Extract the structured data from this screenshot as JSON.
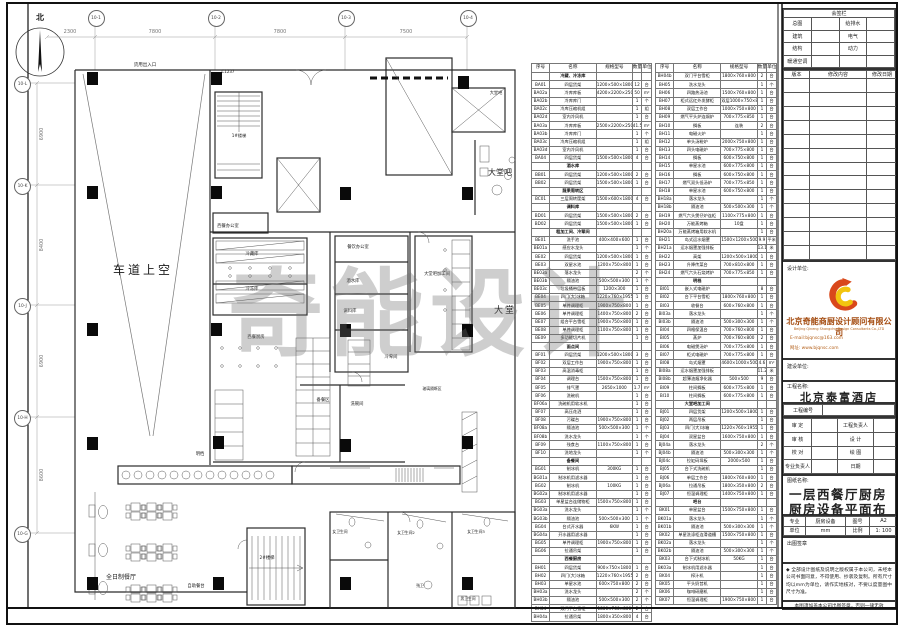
{
  "plan": {
    "north_label": "北",
    "watermark": "奇能设计",
    "grid_top": [
      {
        "id": "10-1",
        "x": 95
      },
      {
        "id": "10-2",
        "x": 215
      },
      {
        "id": "10-3",
        "x": 345
      },
      {
        "id": "10-4",
        "x": 467
      }
    ],
    "dims_top": [
      {
        "v": "2300",
        "x": 70
      },
      {
        "v": "7800",
        "x": 155
      },
      {
        "v": "7800",
        "x": 280
      },
      {
        "v": "7500",
        "x": 406
      }
    ],
    "grid_left": [
      {
        "id": "10-L",
        "y": 83
      },
      {
        "id": "10-K",
        "y": 185
      },
      {
        "id": "10-J",
        "y": 305
      },
      {
        "id": "10-H",
        "y": 417
      },
      {
        "id": "10-G",
        "y": 533
      }
    ],
    "dims_left": [
      {
        "v": "6900",
        "y": 134
      },
      {
        "v": "8400",
        "y": 245
      },
      {
        "v": "6900",
        "y": 361
      },
      {
        "v": "8600",
        "y": 475
      }
    ],
    "columns": [
      [
        92,
        78
      ],
      [
        216,
        78
      ],
      [
        463,
        82
      ],
      [
        92,
        192
      ],
      [
        216,
        192
      ],
      [
        345,
        193
      ],
      [
        467,
        193
      ],
      [
        92,
        329
      ],
      [
        216,
        329
      ],
      [
        345,
        330
      ],
      [
        467,
        330
      ],
      [
        92,
        443
      ],
      [
        218,
        442
      ],
      [
        345,
        445
      ],
      [
        467,
        442
      ],
      [
        92,
        583
      ],
      [
        218,
        583
      ],
      [
        345,
        583
      ],
      [
        467,
        583
      ]
    ],
    "labels": [
      {
        "t": "北",
        "x": 40,
        "y": 12,
        "s": 8,
        "b": 1
      },
      {
        "t": "货用出入口",
        "x": 145,
        "y": 62,
        "s": 4.5
      },
      {
        "t": "C1237",
        "x": 228,
        "y": 69,
        "s": 4
      },
      {
        "t": "1#楼梯",
        "x": 239,
        "y": 133,
        "s": 4.2
      },
      {
        "t": "大堂吧",
        "x": 496,
        "y": 90,
        "s": 4.2
      },
      {
        "t": "大堂吧",
        "x": 500,
        "y": 167,
        "s": 8
      },
      {
        "t": "车道上空",
        "x": 143,
        "y": 261,
        "s": 12,
        "ls": 3
      },
      {
        "t": "西餐办公室",
        "x": 228,
        "y": 223,
        "s": 4.3
      },
      {
        "t": "冷藏库",
        "x": 252,
        "y": 251,
        "s": 4.3
      },
      {
        "t": "冷冻库",
        "x": 252,
        "y": 286,
        "s": 4.3
      },
      {
        "t": "餐饮办公室",
        "x": 358,
        "y": 244,
        "s": 4.3
      },
      {
        "t": "酒水库",
        "x": 353,
        "y": 278,
        "s": 4.3
      },
      {
        "t": "调料库",
        "x": 350,
        "y": 308,
        "s": 4.3
      },
      {
        "t": "冷荤间",
        "x": 391,
        "y": 354,
        "s": 4.3
      },
      {
        "t": "大堂吧加工间",
        "x": 437,
        "y": 271,
        "s": 4.3
      },
      {
        "t": "大堂",
        "x": 505,
        "y": 303,
        "s": 9,
        "ls": 2
      },
      {
        "t": "西餐厨房",
        "x": 256,
        "y": 334,
        "s": 4.3
      },
      {
        "t": "备餐区",
        "x": 323,
        "y": 397,
        "s": 4.3
      },
      {
        "t": "洗碗间",
        "x": 357,
        "y": 401,
        "s": 4.3
      },
      {
        "t": "玻璃隔断区",
        "x": 432,
        "y": 386,
        "s": 3.8
      },
      {
        "t": "明档",
        "x": 200,
        "y": 451,
        "s": 4.3
      },
      {
        "t": "自助餐台",
        "x": 196,
        "y": 583,
        "s": 4.3
      },
      {
        "t": "2#楼梯",
        "x": 267,
        "y": 555,
        "s": 4.3
      },
      {
        "t": "全日制餐厅",
        "x": 121,
        "y": 572,
        "s": 6
      },
      {
        "t": "女卫生间",
        "x": 340,
        "y": 529,
        "s": 3.8
      },
      {
        "t": "女卫生间2",
        "x": 406,
        "y": 530,
        "s": 3.8
      },
      {
        "t": "女卫生间3",
        "x": 476,
        "y": 529,
        "s": 3.8
      },
      {
        "t": "残卫",
        "x": 420,
        "y": 583,
        "s": 3.8
      },
      {
        "t": "男卫生间",
        "x": 468,
        "y": 596,
        "s": 3.8
      }
    ]
  },
  "tables": {
    "headers": [
      "序号",
      "名称",
      "规格型号",
      "数量",
      "单位"
    ],
    "left_rows": [
      {
        "s": "冷藏、冷冻库"
      },
      [
        "BA01",
        "四层货架",
        "1200×500×1800",
        "12",
        "台"
      ],
      [
        "BA02a",
        "冷库库板",
        "4200×2200×2500",
        "50",
        "m²"
      ],
      [
        "BA02b",
        "冷库库门",
        "",
        "1",
        "个"
      ],
      [
        "BA02c",
        "冷库压缩机组",
        "",
        "1",
        "组"
      ],
      [
        "BA02d",
        "室内冷风机",
        "",
        "1",
        "台"
      ],
      [
        "BA03a",
        "冷库库板",
        "2500×2200×2500",
        "41.5",
        "m²"
      ],
      [
        "BA03b",
        "冷库库门",
        "",
        "1",
        "个"
      ],
      [
        "BA03c",
        "冷库压缩机组",
        "",
        "1",
        "组"
      ],
      [
        "BA03d",
        "室内冷风机",
        "",
        "1",
        "台"
      ],
      [
        "BA04",
        "四层货架",
        "1500×500×1800",
        "4",
        "台"
      ],
      {
        "s": "酒水库"
      },
      [
        "BB01",
        "四层货架",
        "1200×500×1800",
        "2",
        "台"
      ],
      [
        "BB02",
        "四层货架",
        "1500×500×1800",
        "1",
        "台"
      ],
      {
        "s": "蔬果周转区"
      },
      [
        "BC01",
        "三层周转筐架",
        "1500×600×1800",
        "4",
        "台"
      ],
      {
        "s": "调料库"
      },
      [
        "BD01",
        "四层货架",
        "1500×500×1800",
        "2",
        "台"
      ],
      [
        "BD02",
        "四层货架",
        "1500×500×1800",
        "1",
        "台"
      ],
      {
        "s": "粗加工间、冷荤间"
      },
      [
        "BE01",
        "洗手池",
        "400×400×600",
        "1",
        "台"
      ],
      [
        "BE01a",
        "感应水龙头",
        "",
        "1",
        "个"
      ],
      [
        "BE02",
        "四层货架",
        "1200×500×1800",
        "1",
        "台"
      ],
      [
        "BE03",
        "双星水池",
        "1200×750×800",
        "1",
        "台"
      ],
      [
        "BE03a",
        "落水龙头",
        "",
        "2",
        "个"
      ],
      [
        "BE03b",
        "隔油池",
        "500×500×300",
        "1",
        "个"
      ],
      [
        "BE03c",
        "垃圾桶带层板",
        "1200×300",
        "1",
        "台"
      ],
      [
        "BE04",
        "四门(大)冰箱",
        "1220×760×1955",
        "1",
        "台"
      ],
      [
        "BE05",
        "单件调理柜",
        "1900×750×800",
        "1",
        "台"
      ],
      [
        "BE06",
        "单件调理柜",
        "1400×750×800",
        "2",
        "台"
      ],
      [
        "BE07",
        "组合平台雪柜",
        "1900×750×800",
        "1",
        "台"
      ],
      [
        "BE08",
        "单件调理柜",
        "1100×750×800",
        "1",
        "台"
      ],
      [
        "BE09",
        "多功能切片机",
        "",
        "1",
        "台"
      ],
      {
        "s": "面点间"
      },
      [
        "BF01",
        "四层货架",
        "1200×500×1800",
        "3",
        "台"
      ],
      [
        "BF02",
        "双层工作台",
        "1900×750×800",
        "1",
        "台"
      ],
      [
        "BF03",
        "高温消毒柜",
        "",
        "1",
        "台"
      ],
      [
        "BF04",
        "调理台",
        "1500×750×800",
        "1",
        "台"
      ],
      [
        "BF05",
        "排气罩",
        "2650×1000",
        "1.7",
        "m²"
      ],
      [
        "BF06",
        "洗碗机",
        "",
        "1",
        "台"
      ],
      [
        "BF06a",
        "洗碗机用软水机",
        "",
        "1",
        "台"
      ],
      [
        "BF07",
        "高压花洒",
        "",
        "1",
        "台"
      ],
      [
        "BF08",
        "污碟台",
        "1900×750×800",
        "1",
        "台"
      ],
      [
        "BF08a",
        "隔油池",
        "500×500×300",
        "1",
        "个"
      ],
      [
        "BF08b",
        "洗水龙头",
        "",
        "1",
        "个"
      ],
      [
        "BF09",
        "残食台",
        "1100×750×800",
        "1",
        "台"
      ],
      [
        "BF10",
        "洗地龙头",
        "",
        "1",
        "个"
      ],
      {
        "s": "备餐间"
      },
      [
        "BG01",
        "制冰机",
        "300KG",
        "1",
        "台"
      ],
      [
        "BG01a",
        "制冰机用滤水器",
        "",
        "1",
        "台"
      ],
      [
        "BG02",
        "制冰机",
        "100KG",
        "1",
        "台"
      ],
      [
        "BG02a",
        "制冰机用滤水器",
        "",
        "1",
        "台"
      ],
      [
        "BG03",
        "单星盆台连储物柜",
        "1500×750×800",
        "1",
        "台"
      ],
      [
        "BG03a",
        "洗水龙头",
        "",
        "1",
        "个"
      ],
      [
        "BG03b",
        "隔油池",
        "500×500×300",
        "1",
        "个"
      ],
      [
        "BG04",
        "台式开水器",
        "6KW",
        "1",
        "台"
      ],
      [
        "BG04a",
        "开水器用滤水器",
        "",
        "1",
        "台"
      ],
      [
        "BG05",
        "单件调理柜",
        "1900×750×800",
        "1",
        "台"
      ],
      [
        "BG06",
        "拉通吊架",
        "",
        "1",
        "台"
      ],
      {
        "s": "西餐厨房"
      },
      [
        "BH01",
        "四层货架",
        "900×750×1800",
        "1",
        "台"
      ],
      [
        "BH02",
        "四门(大)冰箱",
        "1220×760×1955",
        "2",
        "台"
      ],
      [
        "BH03",
        "单星水池",
        "600×750×800",
        "2",
        "台"
      ],
      [
        "BH03a",
        "洗水龙头",
        "",
        "2",
        "个"
      ],
      [
        "BH03b",
        "隔油池",
        "500×500×300",
        "2",
        "个"
      ],
      [
        "BH04",
        "双门平台雪柜",
        "1800×760×800",
        "2",
        "台"
      ],
      [
        "BH04a",
        "拉通吊架",
        "1800×350×800",
        "4",
        "台"
      ]
    ],
    "right_rows": [
      [
        "BH04b",
        "双门平台雪柜",
        "1800×760×800",
        "2",
        "台"
      ],
      [
        "BH05",
        "洗水龙头",
        "",
        "1",
        "个"
      ],
      [
        "BH06",
        "四路热汤池",
        "1500×760×800",
        "1",
        "台"
      ],
      [
        "BH07",
        "柜式远红外发酵柜",
        "双层1000×750×800",
        "1",
        "台"
      ],
      [
        "BH08",
        "双层工作台",
        "1000×750×800",
        "1",
        "台"
      ],
      [
        "BH09",
        "燃气平头炉连焗炉",
        "700×775×850",
        "1",
        "台"
      ],
      [
        "BH10",
        "搁板",
        "连装",
        "2",
        "台"
      ],
      [
        "BH11",
        "电磁火炉",
        "",
        "1",
        "台"
      ],
      [
        "BH12",
        "单头汤粉炉",
        "2000×750×800",
        "1",
        "台"
      ],
      [
        "BH13",
        "四头电磁炉",
        "700×775×800",
        "1",
        "台"
      ],
      [
        "BH14",
        "搁板",
        "600×750×800",
        "1",
        "台"
      ],
      [
        "BH15",
        "单星水池",
        "600×775×800",
        "1",
        "台"
      ],
      [
        "BH16",
        "搁板",
        "600×750×800",
        "1",
        "台"
      ],
      [
        "BH17",
        "燃气双头低汤炉",
        "700×775×850",
        "1",
        "台"
      ],
      [
        "BH18",
        "单星水池",
        "600×750×800",
        "1",
        "台"
      ],
      [
        "BH18a",
        "落水龙头",
        "",
        "1",
        "个"
      ],
      [
        "BH18b",
        "隔油池",
        "500×500×300",
        "1",
        "个"
      ],
      [
        "BH19",
        "燃气六头煲仔炉连柜",
        "1100×775×800",
        "1",
        "台"
      ],
      [
        "BH20",
        "万能蒸烤箱",
        "10盘",
        "1",
        "台"
      ],
      [
        "BH20a",
        "万能蒸烤箱用软水机",
        "",
        "1",
        "台"
      ],
      [
        "BH21",
        "岛式运水烟罩",
        "1500×1200×500",
        "9.9",
        "平米"
      ],
      [
        "BH21a",
        "运水烟罩加强排板",
        "",
        "13.1",
        "米"
      ],
      [
        "BH22",
        "高架",
        "1200×500×1800",
        "1",
        "台"
      ],
      [
        "BH23",
        "升降传菜台",
        "700×810×800",
        "1",
        "台"
      ],
      [
        "BH24",
        "燃气六头石烧烤炉",
        "700×775×850",
        "1",
        "台"
      ],
      {
        "s": "明档"
      },
      [
        "BI01",
        "嵌入式电磁炉",
        "",
        "8",
        "台"
      ],
      [
        "BI02",
        "台下平台雪柜",
        "1800×760×800",
        "1",
        "台"
      ],
      [
        "BI03",
        "收餐台",
        "600×760×800",
        "1",
        "台"
      ],
      [
        "BI03a",
        "落水龙头",
        "",
        "1",
        "个"
      ],
      [
        "BI03b",
        "隔油池",
        "500×300×300",
        "1",
        "个"
      ],
      [
        "BI04",
        "四格保温台",
        "700×760×800",
        "1",
        "台"
      ],
      [
        "BI05",
        "蒸炉",
        "700×760×800",
        "2",
        "台"
      ],
      [
        "BI06",
        "电磁煲汤炉",
        "700×775×800",
        "1",
        "台"
      ],
      [
        "BI07",
        "柜式电磁炉",
        "700×775×800",
        "1",
        "台"
      ],
      [
        "BI08",
        "岛式烟罩",
        "4600×1000×500",
        "4.6",
        "m²"
      ],
      [
        "BI08a",
        "运水烟罩加强排板",
        "",
        "11.2",
        "米"
      ],
      [
        "BI08b",
        "超薄油烟净化器",
        "500×500",
        "9",
        "台"
      ],
      [
        "BI09",
        "柱间搁板",
        "600×775×800",
        "1",
        "台"
      ],
      [
        "BI10",
        "柱间搁板",
        "600×775×800",
        "1",
        "台"
      ],
      {
        "s": "大堂吧加工间"
      },
      [
        "BJ01",
        "四层货架",
        "1200×500×1800",
        "1",
        "台"
      ],
      [
        "BJ02",
        "两层吊板",
        "",
        "1",
        "台"
      ],
      [
        "BJ03",
        "四门(大)冰箱",
        "1220×760×1955",
        "1",
        "台"
      ],
      [
        "BJ04",
        "双星盆台",
        "1600×750×800",
        "1",
        "台"
      ],
      [
        "BJ04a",
        "落水龙头",
        "",
        "2",
        "个"
      ],
      [
        "BJ04b",
        "隔油池",
        "500×300×300",
        "1",
        "个"
      ],
      [
        "BJ04c",
        "拉缸码垛板",
        "2000×500",
        "1",
        "台"
      ],
      [
        "BJ05",
        "台下式洗碗机",
        "",
        "1",
        "台"
      ],
      [
        "BJ06",
        "单层工作台",
        "1800×760×800",
        "1",
        "台"
      ],
      [
        "BJ06a",
        "拉通吊板",
        "1800×350×800",
        "2",
        "台"
      ],
      [
        "BJ07",
        "恒温调理柜",
        "1400×750×800",
        "1",
        "台"
      ],
      {
        "s": "吧台"
      },
      [
        "BK01",
        "单星盆台",
        "1500×750×800",
        "1",
        "台"
      ],
      [
        "BK01a",
        "落水龙头",
        "",
        "1",
        "个"
      ],
      [
        "BK01b",
        "隔油池",
        "500×300×300",
        "1",
        "个"
      ],
      [
        "BK02",
        "单星洗涤柜连滑道槽",
        "1500×750×800",
        "1",
        "台"
      ],
      [
        "BK02a",
        "落水龙头",
        "",
        "1",
        "个"
      ],
      [
        "BK02b",
        "隔油池",
        "500×300×300",
        "1",
        "个"
      ],
      [
        "BK03",
        "台下式制冰机",
        "50KG",
        "1",
        "台"
      ],
      [
        "BK03a",
        "制冰机用滤水器",
        "",
        "1",
        "台"
      ],
      [
        "BK04",
        "榨汁机",
        "",
        "1",
        "台"
      ],
      [
        "BK05",
        "平头奶昔机",
        "",
        "1",
        "台"
      ],
      [
        "BK06",
        "咖啡研磨机",
        "",
        "1",
        "台"
      ],
      [
        "BK07",
        "恒温调理柜",
        "1900×750×800",
        "1",
        "台"
      ]
    ]
  },
  "titleblock": {
    "sign_title": "会签栏",
    "sign_pairs": [
      [
        "总图",
        "给排水"
      ],
      [
        "建筑",
        "电气"
      ],
      [
        "结构",
        "动力"
      ],
      [
        "暖通空调",
        ""
      ]
    ],
    "revision_headers": [
      "版本",
      "修改内容",
      "修改日期"
    ],
    "revision_empty_rows": 13,
    "design_unit_label": "设计单位:",
    "company_cn": "北京奇能商厨设计顾问有限公司",
    "company_en": "Beijing Qineng Shangchu Design Consultants Co.,LTD",
    "email": "E-mail:bjqnsc@163.com",
    "website": "网址: www.bjqnsc.com",
    "build_unit_label": "建设单位:",
    "project_label": "工程名称:",
    "project_name": "北京泰富酒店",
    "project_no_label": "工程编号",
    "roles": [
      [
        "审 定",
        "工程负责人"
      ],
      [
        "审 核",
        "设 计"
      ],
      [
        "校 对",
        "绘 图"
      ],
      [
        "专业负责人",
        "日期"
      ]
    ],
    "drawing_label": "图纸名称:",
    "drawing_name_1": "一层西餐厅厨房",
    "drawing_name_2": "厨房设备平面布置图",
    "meta_rows": [
      [
        "专业",
        "厨房设备",
        "图号",
        "A2"
      ],
      [
        "单位",
        "mm",
        "比例",
        "1: 100"
      ]
    ],
    "stamp_label": "出图签章",
    "notes": "◆ 全部设计图纸及说明之版权属于本公司，未经本公司书面同意，不得使用、抄袭及复制。所有尺寸均以mm为单位，请作实地核对，不要以度量图中尺寸为准。",
    "note_bottom": "本图须加盖本公司出图签章，否则一律无效",
    "logo_colors": {
      "red": "#d9481b",
      "orange": "#f08300",
      "yellow": "#f2c40f"
    }
  }
}
